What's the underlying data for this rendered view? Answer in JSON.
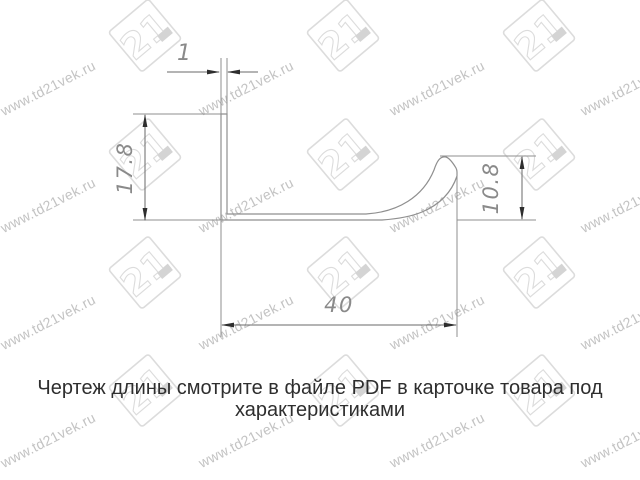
{
  "drawing": {
    "type": "profile-cross-section",
    "line_color": "#8f8f8f",
    "dim_line_color": "#6a6a6a",
    "arrow_color": "#2e2e2e",
    "dim_text_color": "#8a8a8a"
  },
  "dimensions": {
    "wall_thickness": "1",
    "left_height": "17.8",
    "right_height": "10.8",
    "bottom_width": "40"
  },
  "note": {
    "line1": "Чертеж длины смотрите в файле PDF в карточке товара под",
    "line2": "характеристиками"
  },
  "watermark": {
    "text": "www.td21vek.ru",
    "logo_text": "21",
    "text_color": "#c3c3c3",
    "logo_color": "#dcdcdc",
    "text_positions": [
      [
        48,
        88
      ],
      [
        246,
        88
      ],
      [
        437,
        88
      ],
      [
        628,
        88
      ],
      [
        48,
        205
      ],
      [
        246,
        205
      ],
      [
        437,
        205
      ],
      [
        628,
        205
      ],
      [
        48,
        322
      ],
      [
        246,
        322
      ],
      [
        437,
        322
      ],
      [
        628,
        322
      ],
      [
        48,
        440
      ],
      [
        246,
        440
      ],
      [
        437,
        440
      ],
      [
        628,
        440
      ]
    ],
    "logo_positions": [
      [
        145,
        38
      ],
      [
        343,
        38
      ],
      [
        539,
        38
      ],
      [
        145,
        157
      ],
      [
        343,
        157
      ],
      [
        539,
        157
      ],
      [
        145,
        275
      ],
      [
        343,
        275
      ],
      [
        539,
        275
      ],
      [
        145,
        393
      ],
      [
        343,
        393
      ],
      [
        539,
        393
      ]
    ]
  }
}
